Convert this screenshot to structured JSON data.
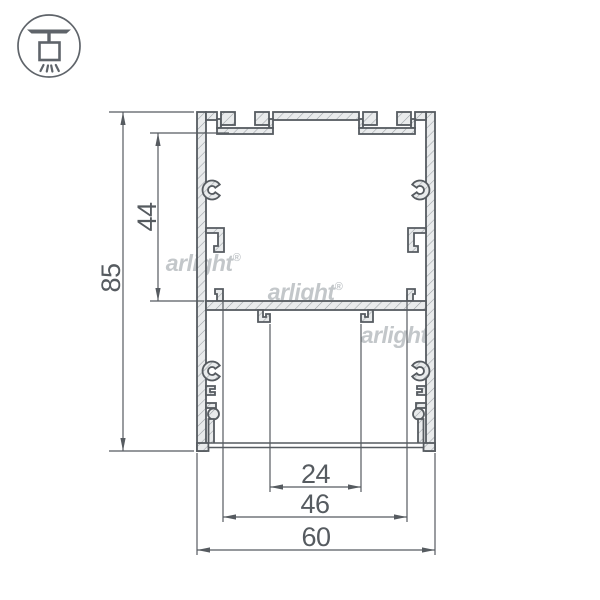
{
  "badge": {
    "icon": "ceiling-pendant-light"
  },
  "drawing": {
    "kind": "aluminum-profile-cross-section",
    "watermark": {
      "text": "arlight",
      "reg": "®"
    },
    "dims": {
      "total_height": "85",
      "upper_inner_height": "44",
      "hook_span": "24",
      "tab_span": "46",
      "total_width": "60"
    },
    "colors": {
      "outline": "#565b60",
      "hatch": "#9aa0a4",
      "metal_fill": "#e9ebec",
      "dimension": "#565b60",
      "watermark": "#c3c7ca",
      "badge": "#5f646a"
    }
  }
}
